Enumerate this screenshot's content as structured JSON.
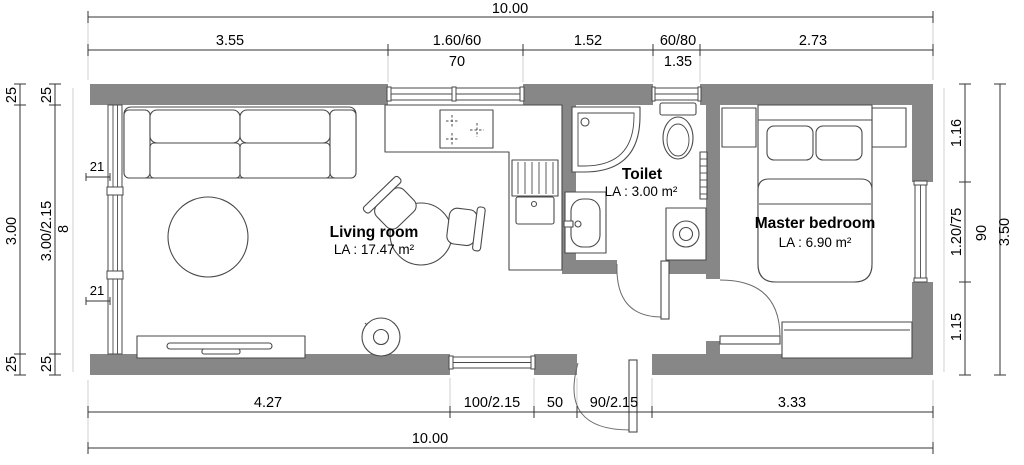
{
  "colors": {
    "wall": "#878787",
    "line": "#4a4a4a",
    "dim": "#333333",
    "ext": "#c4c4c4",
    "text": "#000000",
    "bg": "#ffffff"
  },
  "rooms": [
    {
      "name": "Living room",
      "area": "LA : 17.47 m²"
    },
    {
      "name": "Toilet",
      "area": "LA : 3.00 m²"
    },
    {
      "name": "Master bedroom",
      "area": "LA : 6.90 m²"
    }
  ],
  "dimensions": {
    "top": {
      "overall": "10.00",
      "segments": [
        "3.55",
        "1.60/60",
        "1.52",
        "60/80",
        "2.73"
      ],
      "sills": [
        "70",
        "1.35"
      ]
    },
    "bottom": {
      "overall": "10.00",
      "segments": [
        "4.27",
        "100/2.15",
        "50",
        "90/2.15",
        "3.33"
      ]
    },
    "left": {
      "outer": [
        "25",
        "3.00",
        "25"
      ],
      "inner": [
        "25",
        "3.00/2.15",
        "25"
      ],
      "sill": "8",
      "mullions": [
        "21",
        "21"
      ]
    },
    "right": {
      "segments": [
        "1.16",
        "1.20/75",
        "1.15"
      ],
      "sill": "90",
      "overall": "3.50"
    }
  }
}
